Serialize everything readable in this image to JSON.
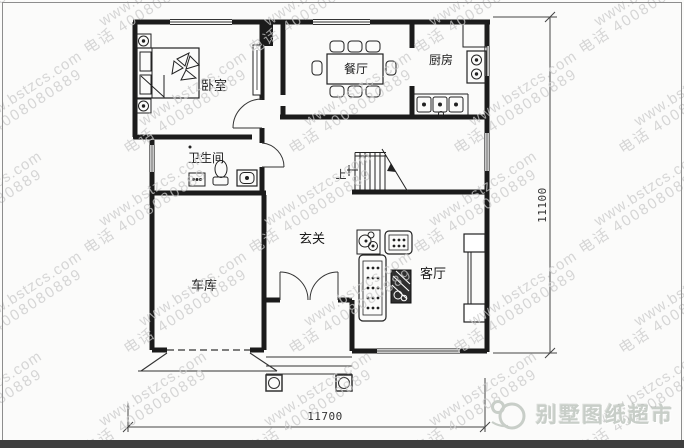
{
  "frame": {
    "border_color": "#8d8d8d",
    "background": "#fbfbfa",
    "bottom_bar_color": "#3f3f3f"
  },
  "watermark": {
    "site": "www.bstzcs.com",
    "phone": "电话 4008080889",
    "color": "#c9c9c9"
  },
  "brand": {
    "name": "别墅图纸超市",
    "color": "#c8cec8"
  },
  "plan": {
    "wall_color": "#1b1b1b",
    "rooms": [
      {
        "id": "bedroom",
        "label": "卧室"
      },
      {
        "id": "dining",
        "label": "餐厅"
      },
      {
        "id": "kitchen",
        "label": "厨房"
      },
      {
        "id": "bathroom",
        "label": "卫生间"
      },
      {
        "id": "entry",
        "label": "玄关"
      },
      {
        "id": "garage",
        "label": "车库"
      },
      {
        "id": "living",
        "label": "客厅"
      }
    ],
    "stairs": {
      "up_label": "上"
    },
    "dimensions": {
      "bottom": "11700",
      "right": "11100"
    }
  }
}
